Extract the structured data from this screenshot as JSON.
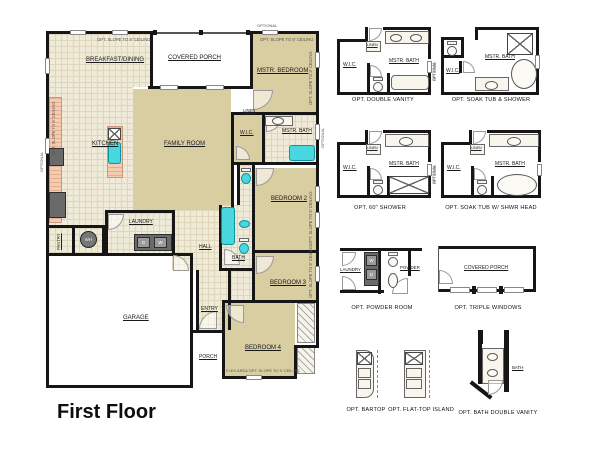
{
  "title": "First Floor",
  "colors": {
    "wall": "#161616",
    "floor_tan": "#d9cda2",
    "tile": "#f0ebd8",
    "counter": "#f4cdb0",
    "fixture_cyan": "#49d6de",
    "background": "#ffffff"
  },
  "plan": {
    "rooms": {
      "breakfast": "BREAKFAST/DINING",
      "covered_porch": "COVERED PORCH",
      "mstr_bedroom": "MSTR. BEDROOM",
      "kitchen": "KITCHEN",
      "family_room": "FAMILY ROOM",
      "wic": "W.I.C.",
      "mstr_bath": "MSTR. BATH",
      "linen": "LINEN",
      "bedroom2": "BEDROOM 2",
      "bath": "BATH",
      "hall": "HALL",
      "laundry": "LAUNDRY",
      "garage": "GARAGE",
      "entry": "ENTRY",
      "porch": "PORCH",
      "bedroom3": "BEDROOM 3",
      "bedroom4": "BEDROOM 4",
      "pantry": "PANTRY"
    },
    "appliances": {
      "dryer": "D",
      "washer": "W",
      "water_heater": "WH"
    },
    "notes": {
      "slope": "OPT. SLOPE TO 9' CEILING",
      "flex": "FLEX AREA OPT. SLOPE TO 9' CEILING",
      "optional": "OPTIONAL"
    }
  },
  "options": [
    {
      "caption": "OPT. DOUBLE VANITY",
      "wic": "W.I.C.",
      "bath": "MSTR. BATH",
      "linen": "LINEN"
    },
    {
      "caption": "OPT. SOAK TUB & SHOWER",
      "wic": "W.I.C.",
      "bath": "MSTR. BATH"
    },
    {
      "caption": "OPT. 60\" SHOWER",
      "wic": "W.I.C.",
      "bath": "MSTR. BATH",
      "linen": "LINEN"
    },
    {
      "caption": "OPT. SOAK TUB W/ SHWR HEAD",
      "wic": "W.I.C.",
      "bath": "MSTR. BATH",
      "linen": "LINEN"
    },
    {
      "caption": "OPT. POWDER ROOM",
      "laundry": "LAUNDRY",
      "powder": "POWDER",
      "washer": "W",
      "dryer": "D"
    },
    {
      "caption": "OPT. TRIPLE WINDOWS",
      "porch": "COVERED PORCH"
    },
    {
      "caption": "OPT. BARTOP"
    },
    {
      "caption": "OPT. FLAT-TOP ISLAND"
    },
    {
      "caption": "OPT. BATH DOUBLE VANITY",
      "bath": "BATH"
    }
  ]
}
